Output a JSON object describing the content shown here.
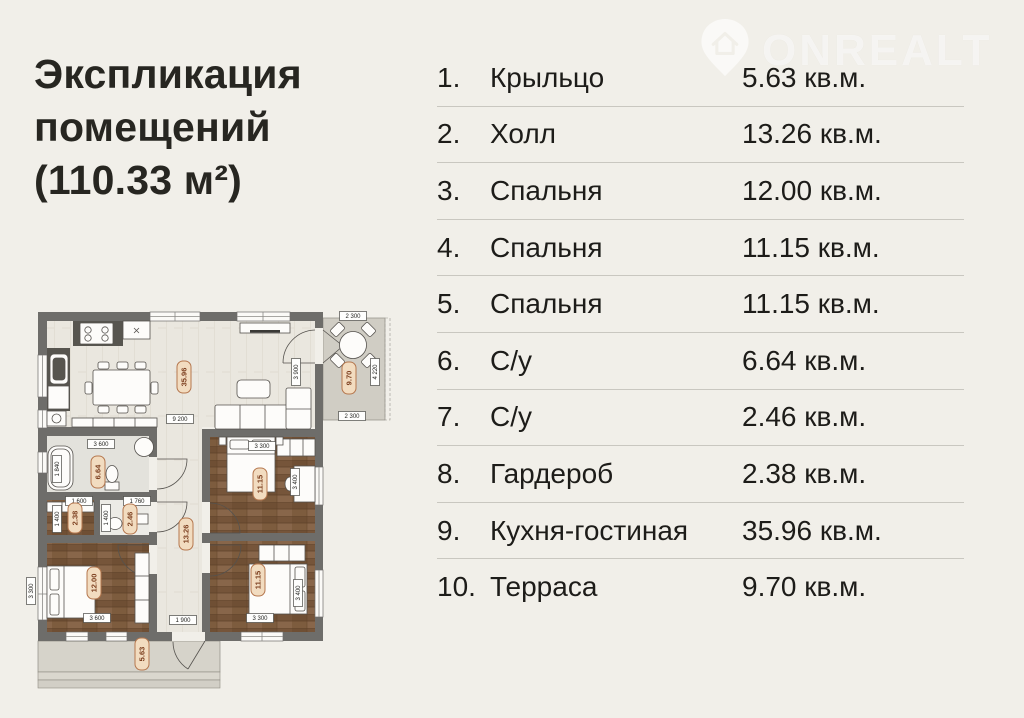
{
  "title": {
    "line1": "Экспликация",
    "line2": "помещений",
    "line3": "(110.33 м²)"
  },
  "watermark": {
    "brand": "ONREALT",
    "icon": "house-pin-icon"
  },
  "table": {
    "rows": [
      {
        "num": "1.",
        "name": "Крыльцо",
        "area": "5.63 кв.м."
      },
      {
        "num": "2.",
        "name": "Холл",
        "area": "13.26 кв.м."
      },
      {
        "num": "3.",
        "name": "Спальня",
        "area": "12.00 кв.м."
      },
      {
        "num": "4.",
        "name": "Спальня",
        "area": "11.15 кв.м."
      },
      {
        "num": "5.",
        "name": "Спальня",
        "area": "11.15 кв.м."
      },
      {
        "num": "6.",
        "name": "С/у",
        "area": "6.64 кв.м."
      },
      {
        "num": "7.",
        "name": "С/у",
        "area": "2.46 кв.м."
      },
      {
        "num": "8.",
        "name": "Гардероб",
        "area": "2.38 кв.м."
      },
      {
        "num": "9.",
        "name": "Кухня-гостиная",
        "area": "35.96 кв.м."
      },
      {
        "num": "10.",
        "name": "Терраса",
        "area": "9.70 кв.м."
      }
    ]
  },
  "plan": {
    "badges": {
      "kitchen": "35.96",
      "terrace": "9.70",
      "bath": "6.64",
      "wardrobe": "2.38",
      "su": "2.46",
      "hall": "13.26",
      "bedroom1": "12.00",
      "bedroom2": "11.15",
      "bedroom3": "11.15",
      "porch": "5.63"
    },
    "dims": {
      "kitchen_w": "9 200",
      "living_h": "3 900",
      "bath_w": "3 600",
      "bath_h": "1 840",
      "wardrobe_w": "1 600",
      "wardrobe_h": "1 400",
      "su_w": "1 760",
      "su_h": "1 400",
      "hall_w": "1 900",
      "bed2_w": "3 300",
      "bed2_h": "3 400",
      "bed3_w": "3 300",
      "bed3_h": "3 400",
      "bed1_w": "3 600",
      "bed1_h": "3 300",
      "terrace_w_top": "2 300",
      "terrace_w_bottom": "2 300",
      "terrace_h": "4 220"
    }
  },
  "colors": {
    "background": "#F1EFE9",
    "wall": "#6E6D6A",
    "wood_dark": "#7C5B3D",
    "badge_fill": "#F2DCC0",
    "badge_border": "#B5774E",
    "badge_text": "#7A3C1C",
    "separator": "#C9C7C0"
  }
}
